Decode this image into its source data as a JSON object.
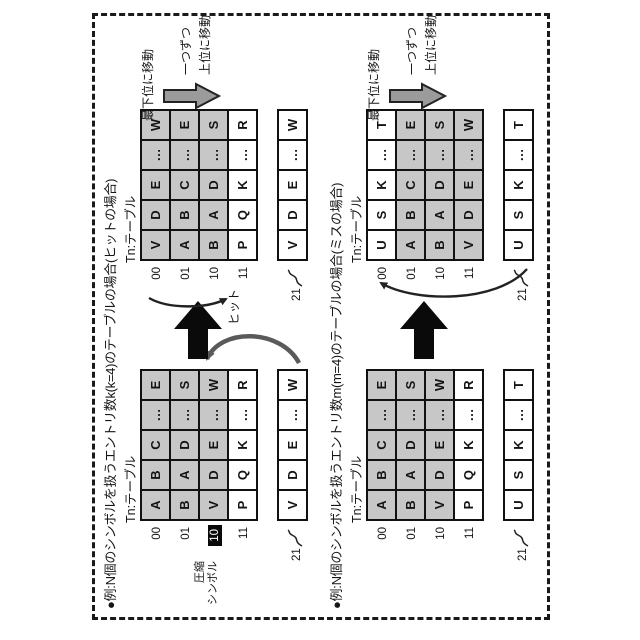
{
  "colors": {
    "shaded_cell": "#c7c7c7",
    "table_border": "#111111",
    "highlight_bg": "#0a0a0a",
    "arrow_black": "#0a0a0a",
    "arrow_gray": "#9b9b9b",
    "arc_gray": "#5a5a5a",
    "frame": "#1a1a1a"
  },
  "cases": [
    {
      "case_id": "hit",
      "title": "●例:N個のシンボルを扱うエントリ数k(k=4)のテーブルの場合(ヒットの場合)",
      "table_label_before": "Tn:テーブル",
      "table_label_after": "Tn:テーブル",
      "compressed_symbol_line1": "圧縮",
      "compressed_symbol_line2": "シンボル",
      "hit_label": "ヒット",
      "annotations": {
        "move_to_lowest": "最下位に移動",
        "one_each": "一つずつ",
        "move_up": "上位に移動"
      },
      "before": {
        "rows": [
          {
            "label": "00",
            "cells": [
              "A",
              "B",
              "C",
              "…",
              "E"
            ]
          },
          {
            "label": "01",
            "cells": [
              "B",
              "A",
              "D",
              "…",
              "S"
            ]
          },
          {
            "label": "10",
            "cells": [
              "V",
              "D",
              "E",
              "…",
              "W"
            ]
          },
          {
            "label": "11",
            "cells": [
              "P",
              "Q",
              "K",
              "…",
              "R"
            ]
          }
        ],
        "register": {
          "label": "21",
          "cells": [
            "V",
            "D",
            "E",
            "…",
            "W"
          ]
        }
      },
      "after": {
        "rows": [
          {
            "label": "00",
            "cells": [
              "V",
              "D",
              "E",
              "…",
              "W"
            ]
          },
          {
            "label": "01",
            "cells": [
              "A",
              "B",
              "C",
              "…",
              "E"
            ]
          },
          {
            "label": "10",
            "cells": [
              "B",
              "A",
              "D",
              "…",
              "S"
            ]
          },
          {
            "label": "11",
            "cells": [
              "P",
              "Q",
              "K",
              "…",
              "R"
            ]
          }
        ],
        "register": {
          "label": "21",
          "cells": [
            "V",
            "D",
            "E",
            "…",
            "W"
          ]
        }
      }
    },
    {
      "case_id": "miss",
      "title": "●例:N個のシンボルを扱うエントリ数m(m=4)のテーブルの場合(ミスの場合)",
      "table_label_before": "Tn:テーブル",
      "table_label_after": "Tn:テーブル",
      "annotations": {
        "move_to_lowest": "最下位に移動",
        "one_each": "一つずつ",
        "move_up": "上位に移動"
      },
      "before": {
        "rows": [
          {
            "label": "00",
            "cells": [
              "A",
              "B",
              "C",
              "…",
              "E"
            ]
          },
          {
            "label": "01",
            "cells": [
              "B",
              "A",
              "D",
              "…",
              "S"
            ]
          },
          {
            "label": "10",
            "cells": [
              "V",
              "D",
              "E",
              "…",
              "W"
            ]
          },
          {
            "label": "11",
            "cells": [
              "P",
              "Q",
              "K",
              "…",
              "R"
            ]
          }
        ],
        "register": {
          "label": "21",
          "cells": [
            "U",
            "S",
            "K",
            "…",
            "T"
          ]
        }
      },
      "after": {
        "rows": [
          {
            "label": "00",
            "cells": [
              "U",
              "S",
              "K",
              "…",
              "T"
            ]
          },
          {
            "label": "01",
            "cells": [
              "A",
              "B",
              "C",
              "…",
              "E"
            ]
          },
          {
            "label": "10",
            "cells": [
              "B",
              "A",
              "D",
              "…",
              "S"
            ]
          },
          {
            "label": "11",
            "cells": [
              "V",
              "D",
              "E",
              "…",
              "W"
            ]
          }
        ],
        "register": {
          "label": "21",
          "cells": [
            "U",
            "S",
            "K",
            "…",
            "T"
          ]
        }
      }
    }
  ]
}
